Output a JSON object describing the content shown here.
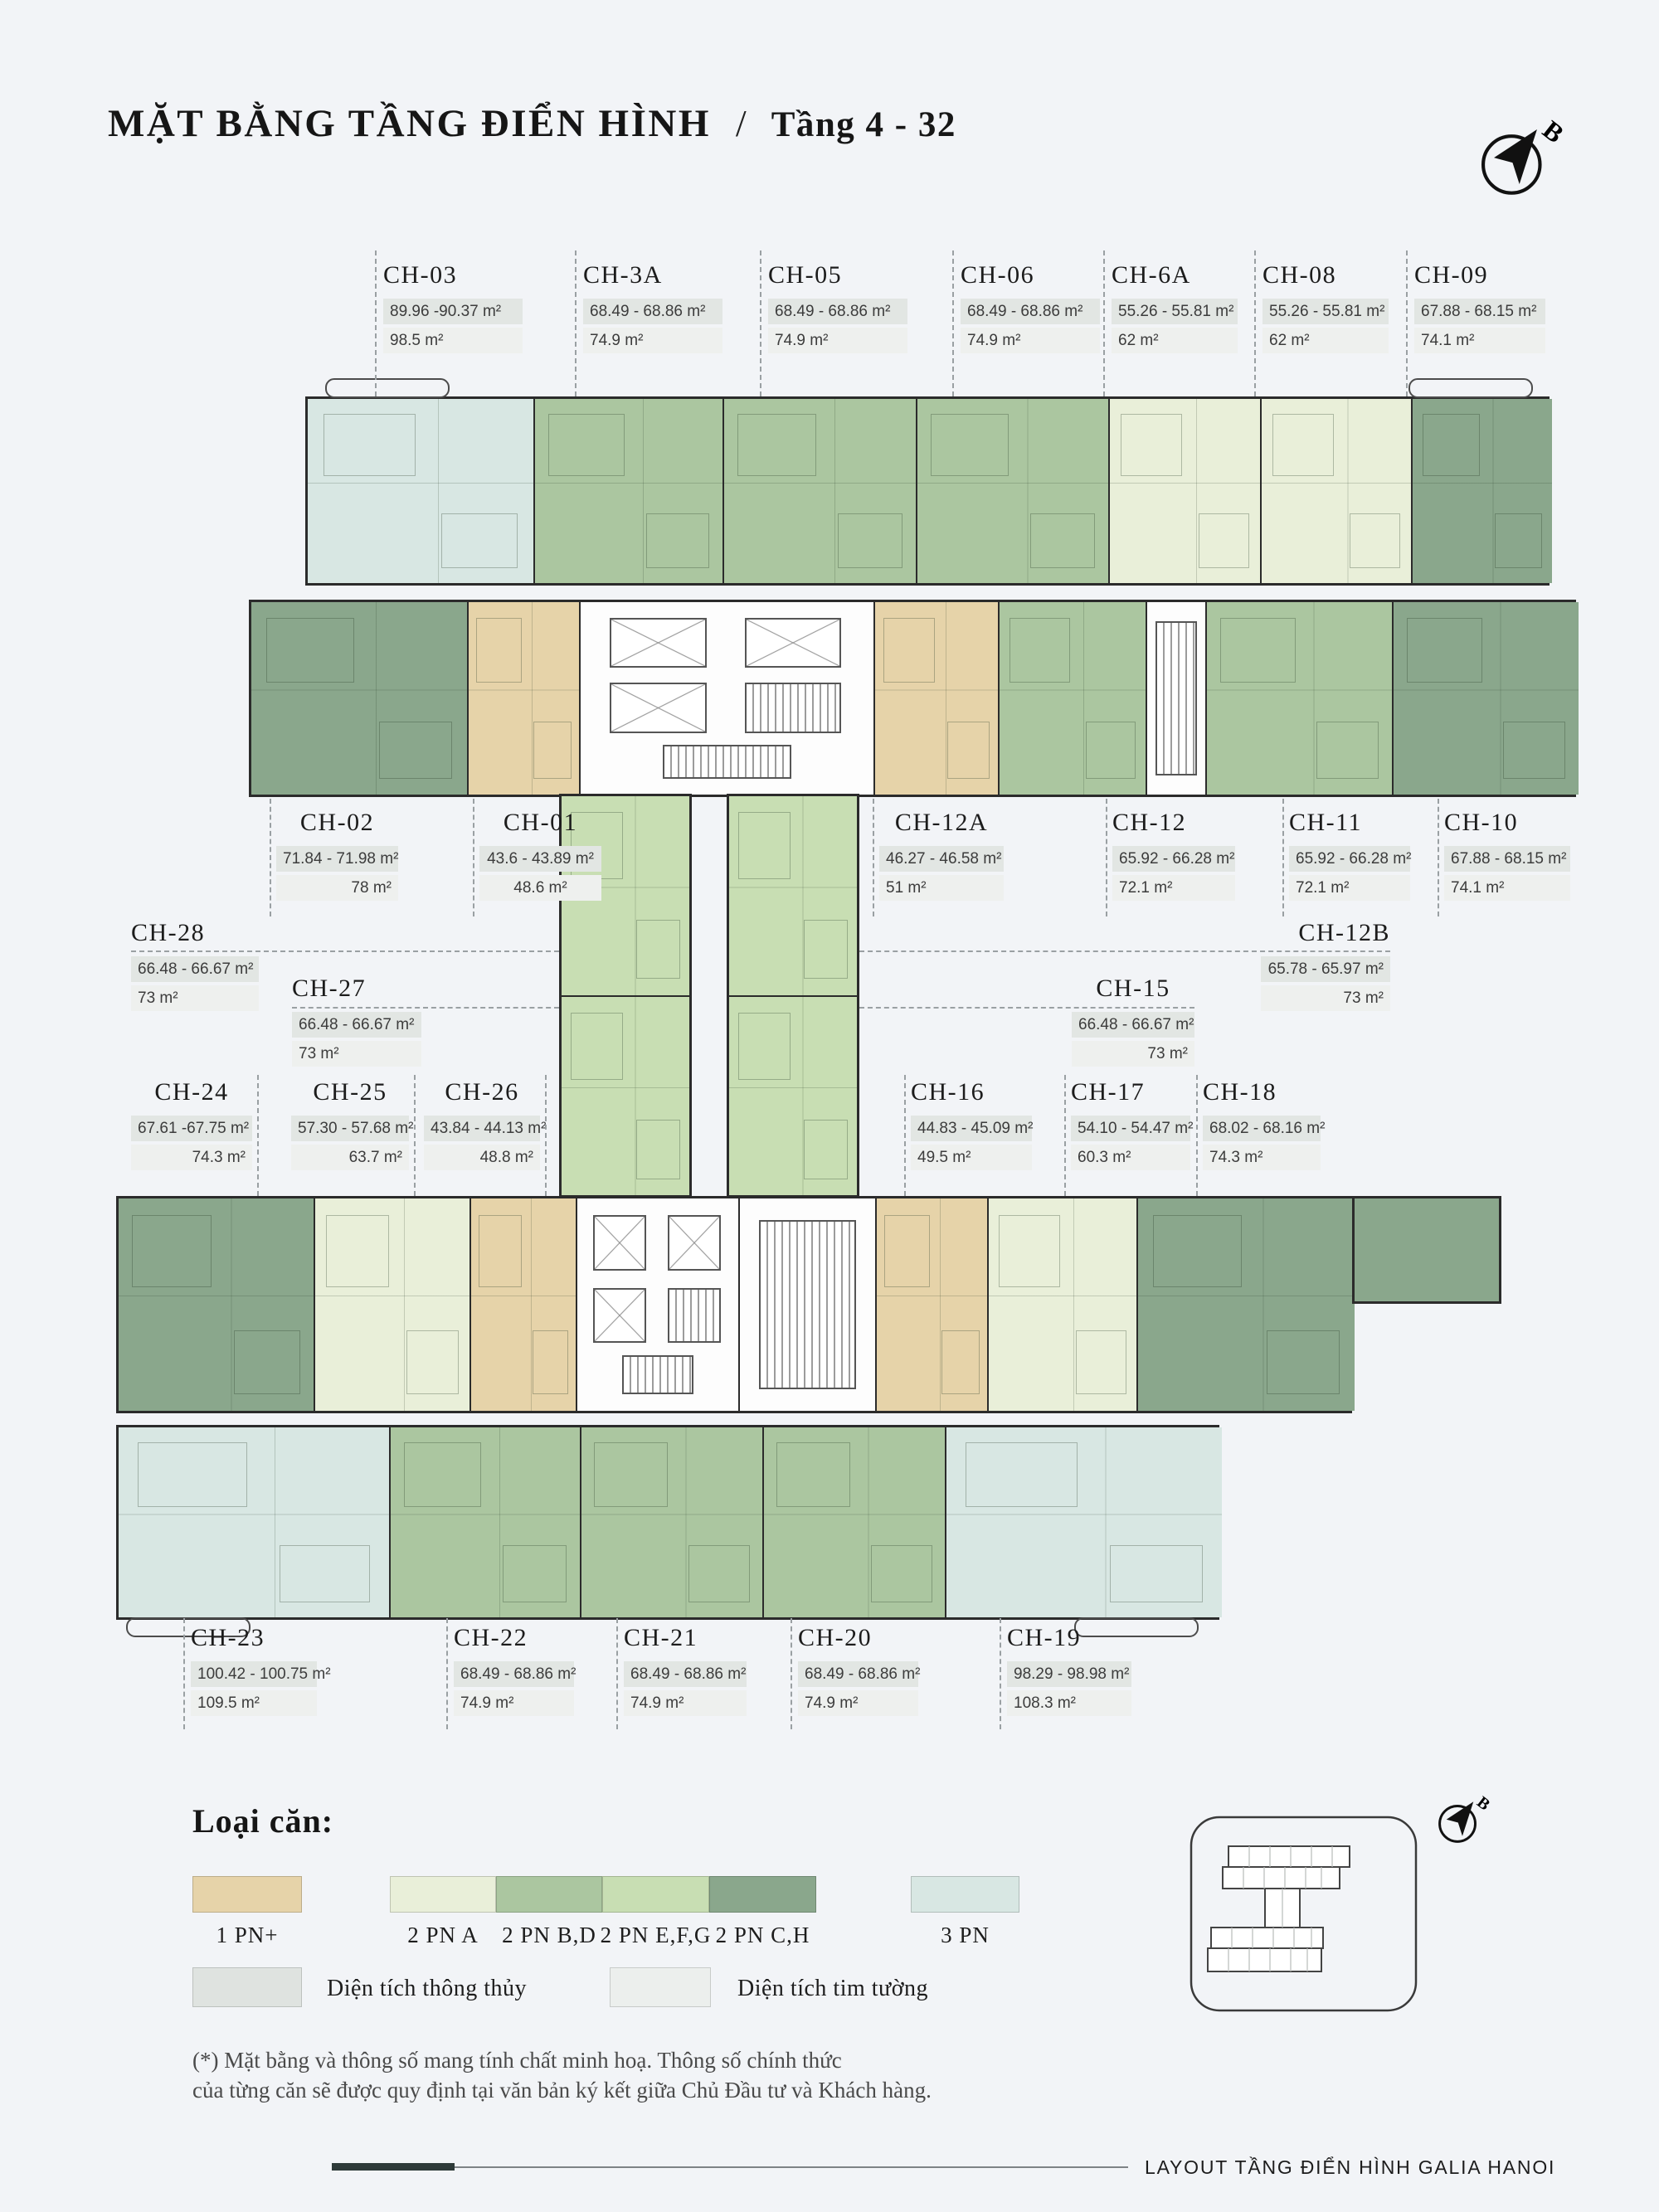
{
  "page": {
    "title": "MẶT BẰNG TẦNG ĐIỂN HÌNH",
    "separator": "/",
    "subtitle": "Tầng 4 - 32",
    "compass_letter": "B"
  },
  "units": [
    {
      "name": "CH-03",
      "range": "89.96 -90.37 m²",
      "area": "98.5 m²",
      "type": "3 PN"
    },
    {
      "name": "CH-3A",
      "range": "68.49 - 68.86 m²",
      "area": "74.9 m²",
      "type": "2 PN B,D"
    },
    {
      "name": "CH-05",
      "range": "68.49 - 68.86 m²",
      "area": "74.9 m²",
      "type": "2 PN B,D"
    },
    {
      "name": "CH-06",
      "range": "68.49 - 68.86 m²",
      "area": "74.9 m²",
      "type": "2 PN B,D"
    },
    {
      "name": "CH-6A",
      "range": "55.26 - 55.81 m²",
      "area": "62 m²",
      "type": "2 PN A"
    },
    {
      "name": "CH-08",
      "range": "55.26 - 55.81 m²",
      "area": "62 m²",
      "type": "2 PN A"
    },
    {
      "name": "CH-09",
      "range": "67.88 - 68.15 m²",
      "area": "74.1 m²",
      "type": "2 PN C,H"
    },
    {
      "name": "CH-02",
      "range": "71.84 - 71.98 m²",
      "area": "78 m²",
      "type": "2 PN C,H"
    },
    {
      "name": "CH-01",
      "range": "43.6 - 43.89 m²",
      "area": "48.6 m²",
      "type": "1 PN+"
    },
    {
      "name": "CH-12A",
      "range": "46.27 - 46.58 m²",
      "area": "51 m²",
      "type": "1 PN+"
    },
    {
      "name": "CH-12",
      "range": "65.92 - 66.28 m²",
      "area": "72.1 m²",
      "type": "2 PN B,D"
    },
    {
      "name": "CH-11",
      "range": "65.92 - 66.28 m²",
      "area": "72.1 m²",
      "type": "2 PN B,D"
    },
    {
      "name": "CH-10",
      "range": "67.88 - 68.15 m²",
      "area": "74.1 m²",
      "type": "2 PN C,H"
    },
    {
      "name": "CH-28",
      "range": "66.48 - 66.67 m²",
      "area": "73 m²",
      "type": "2 PN E,F,G"
    },
    {
      "name": "CH-27",
      "range": "66.48 - 66.67 m²",
      "area": "73 m²",
      "type": "2 PN E,F,G"
    },
    {
      "name": "CH-12B",
      "range": "65.78 - 65.97 m²",
      "area": "73 m²",
      "type": "2 PN E,F,G"
    },
    {
      "name": "CH-15",
      "range": "66.48 - 66.67 m²",
      "area": "73 m²",
      "type": "2 PN E,F,G"
    },
    {
      "name": "CH-24",
      "range": "67.61 -67.75 m²",
      "area": "74.3 m²",
      "type": "2 PN C,H"
    },
    {
      "name": "CH-25",
      "range": "57.30 - 57.68 m²",
      "area": "63.7 m²",
      "type": "2 PN A"
    },
    {
      "name": "CH-26",
      "range": "43.84 - 44.13 m²",
      "area": "48.8 m²",
      "type": "1 PN+"
    },
    {
      "name": "CH-16",
      "range": "44.83 - 45.09 m²",
      "area": "49.5 m²",
      "type": "1 PN+"
    },
    {
      "name": "CH-17",
      "range": "54.10 - 54.47 m²",
      "area": "60.3 m²",
      "type": "2 PN A"
    },
    {
      "name": "CH-18",
      "range": "68.02 - 68.16 m²",
      "area": "74.3 m²",
      "type": "2 PN C,H"
    },
    {
      "name": "CH-23",
      "range": "100.42 - 100.75 m²",
      "area": "109.5 m²",
      "type": "3 PN"
    },
    {
      "name": "CH-22",
      "range": "68.49 - 68.86 m²",
      "area": "74.9 m²",
      "type": "2 PN B,D"
    },
    {
      "name": "CH-21",
      "range": "68.49 - 68.86 m²",
      "area": "74.9 m²",
      "type": "2 PN B,D"
    },
    {
      "name": "CH-20",
      "range": "68.49 - 68.86 m²",
      "area": "74.9 m²",
      "type": "2 PN B,D"
    },
    {
      "name": "CH-19",
      "range": "98.29 - 98.98 m²",
      "area": "108.3 m²",
      "type": "3 PN"
    }
  ],
  "legend": {
    "heading": "Loại căn:",
    "types": [
      {
        "label": "1 PN+",
        "color": "#e6d3a9"
      },
      {
        "label": "2 PN A",
        "color": "#e9efd9"
      },
      {
        "label": "2 PN B,D",
        "color": "#abc6a0"
      },
      {
        "label": "2 PN E,F,G",
        "color": "#c8deb3"
      },
      {
        "label": "2 PN C,H",
        "color": "#8aa78c"
      },
      {
        "label": "3 PN",
        "color": "#d8e7e3"
      }
    ],
    "area_types": [
      {
        "label": "Diện tích thông thủy",
        "color": "#dfe3e0"
      },
      {
        "label": "Diện tích tim tường",
        "color": "#ecefed"
      }
    ]
  },
  "footnote": {
    "line1": "(*) Mặt bằng và thông số mang tính chất minh hoạ. Thông số chính thức",
    "line2": "của từng căn sẽ được quy định tại văn bản ký kết giữa Chủ Đầu tư và Khách hàng."
  },
  "footer": {
    "text": "LAYOUT TẦNG ĐIỂN HÌNH GALIA HANOI"
  }
}
